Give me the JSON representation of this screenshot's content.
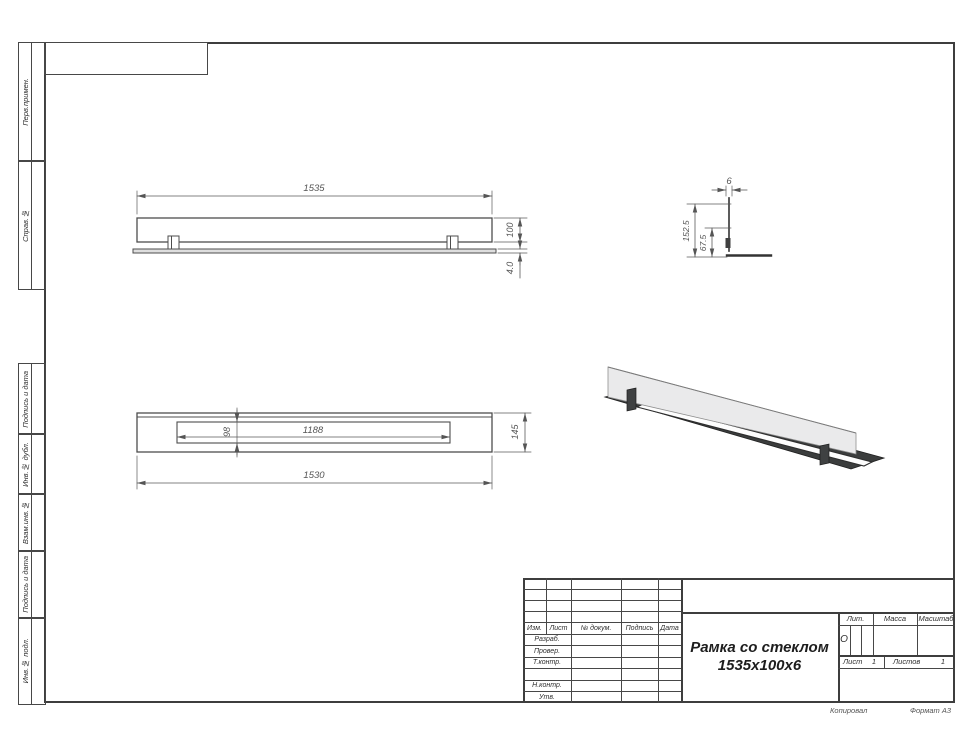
{
  "sheet": {
    "format_note": "Формат А3",
    "kopiroval_note": "Копировал"
  },
  "side_column": {
    "labels": [
      "Перв.примен.",
      "Справ.№",
      "Подпись и дата",
      "Инв.№ дубл.",
      "Взам.инв.№",
      "Подпись и дата",
      "Инв.№ подл."
    ]
  },
  "title_block": {
    "header_cols": [
      "Изм.",
      "Лист",
      "№ докум.",
      "Подпись",
      "Дата"
    ],
    "rows": [
      "Разраб.",
      "Провер.",
      "Т.контр.",
      "Н.контр.",
      "Утв."
    ],
    "doc_title_line1": "Рамка со стеклом",
    "doc_title_line2": "1535x100x6",
    "lit_label": "Лит.",
    "lit_value": "О",
    "massa_label": "Масса",
    "masshtab_label": "Масштаб",
    "list_label": "Лист",
    "list_value": "1",
    "listov_label": "Листов",
    "listov_value": "1"
  },
  "front_view": {
    "dim_length": "1535",
    "dim_height": "100",
    "dim_plate": "4.0"
  },
  "section_view": {
    "dim_thickness": "6",
    "dim_total_height": "152.5",
    "dim_clip_height": "67.5"
  },
  "plan_view": {
    "dim_opening_length": "1188",
    "dim_opening_width": "98",
    "dim_length": "1530",
    "dim_width": "145"
  },
  "colors": {
    "drawing_line": "#4d4d4d",
    "dim_line": "#5a5a5a",
    "glass_fill": "#eaeaeb",
    "metal_fill": "#3b3d3d"
  }
}
